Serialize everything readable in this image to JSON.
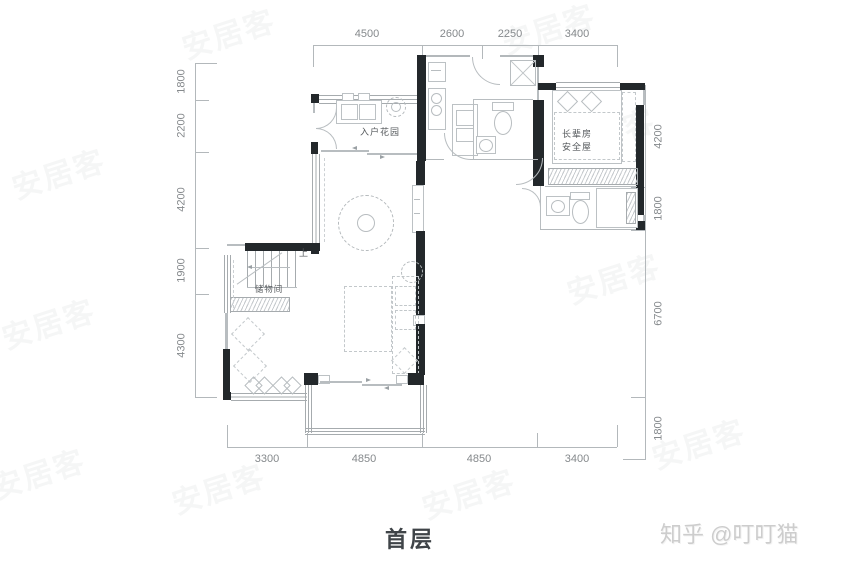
{
  "title": "首层",
  "credit": "知乎 @叮叮猫",
  "watermark": "安居客",
  "colors": {
    "wall": "#23282b",
    "thin_line": "#a6abae",
    "dim_text": "#85898c",
    "room_text": "#55595c",
    "furniture_line": "#b8bdc0"
  },
  "dimensions": {
    "top": [
      "4500",
      "2600",
      "2250",
      "3400"
    ],
    "bottom": [
      "3300",
      "4850",
      "4850",
      "3400"
    ],
    "left": [
      "1800",
      "2200",
      "4200",
      "1900",
      "4300"
    ],
    "right": [
      "4200",
      "1800",
      "6700",
      "1800"
    ]
  },
  "rooms": {
    "entry_garden": "入户花园",
    "elder_room": "长辈房",
    "safe_room": "安全屋",
    "storage": "储物间",
    "stairs_up": "上"
  }
}
